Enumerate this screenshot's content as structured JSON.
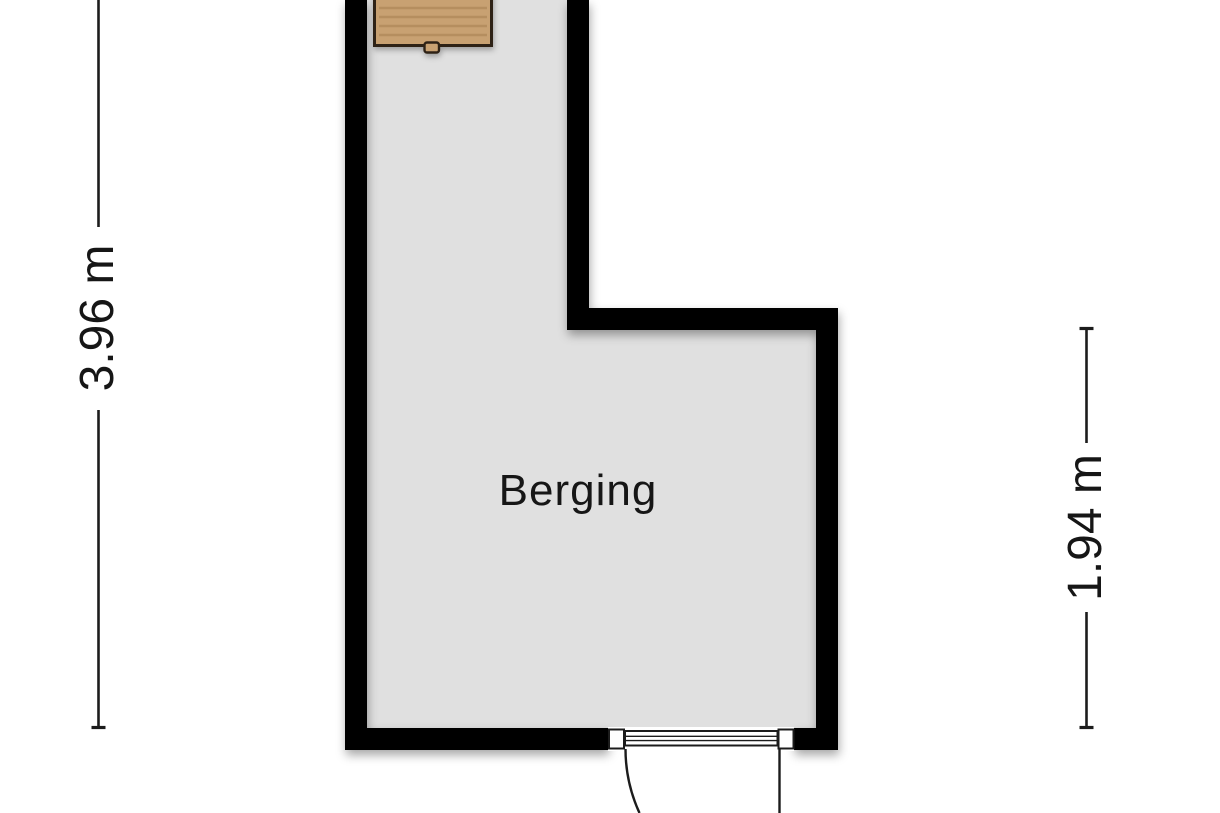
{
  "room": {
    "label": "Berging"
  },
  "dimensions": {
    "left": {
      "label": "3.96 m",
      "orientation": "vertical",
      "side": "left"
    },
    "right": {
      "label": "1.94 m",
      "orientation": "vertical",
      "side": "right"
    }
  },
  "fixtures": {
    "workbench": "workbench",
    "door": "hinged-door"
  },
  "colors": {
    "background": "#ffffff",
    "wall": "#000000",
    "floor": "#e0e0e0",
    "wood": "#c8a172",
    "woodBorder": "#2e2217",
    "doorFill": "#ffffff",
    "line": "#1c1c1c",
    "text": "#161616"
  }
}
